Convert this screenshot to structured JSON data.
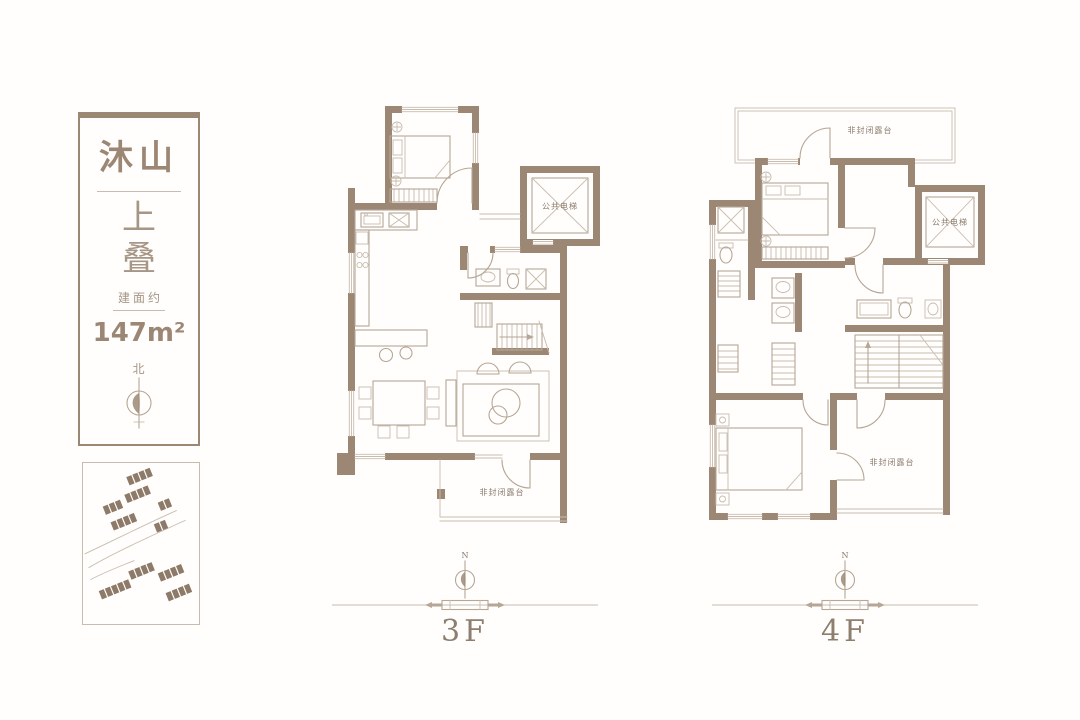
{
  "panel": {
    "brand": "沐山",
    "type_char1": "上",
    "type_char2": "叠",
    "area_label": "建面约",
    "area_value": "147m²",
    "north_label": "北"
  },
  "plans": {
    "f3": {
      "label": "3F",
      "compass_n": "N",
      "elevator": "公共电梯",
      "terrace": "非封闭露台"
    },
    "f4": {
      "label": "4F",
      "compass_n": "N",
      "elevator": "公共电梯",
      "terrace_top": "非封闭露台",
      "terrace_bottom": "非封闭露台"
    }
  },
  "colors": {
    "wall": "#9c8774",
    "thin_line": "#b5a695",
    "faint_line": "#c8bcae",
    "label_text": "#8a7b6c",
    "background": "#ffffff"
  }
}
